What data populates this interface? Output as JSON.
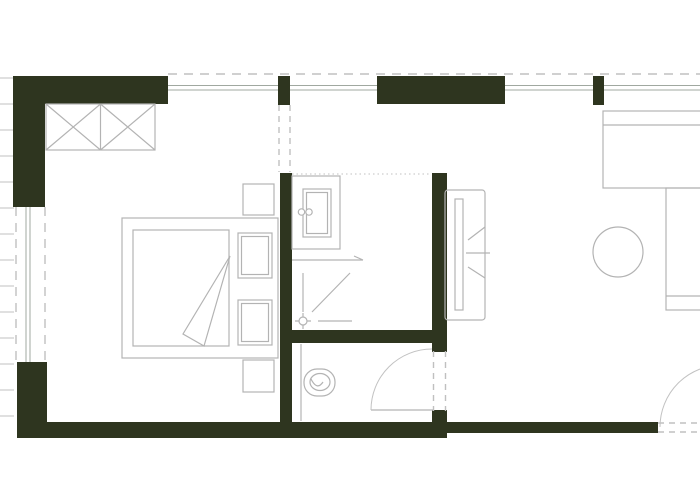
{
  "meta": {
    "type": "architectural-floor-plan",
    "description": "Small apartment plan: bedroom with wardrobe and double bed (left), bathroom with vanity and shower (center top), WC with toilet (center bottom), living area with TV unit, daybed, desk and round table (right). No text labels visible.",
    "canvas": {
      "width": 700,
      "height": 500
    },
    "background": "#ffffff"
  },
  "colors": {
    "wall": "#2e351f",
    "furniture_line": "#b3b3b3",
    "thin_line": "#c2c2c2",
    "window_line": "#a0a8a0",
    "dashed_line": "#c0c0c0"
  },
  "layers": [
    {
      "name": "exterior-hatching",
      "items": [
        {
          "name": "facade-hatch-marks",
          "kind": "path",
          "style": "thin",
          "d": "M0,78 H14 M0,104 H14 M0,130 H14 M0,156 H14 M0,182 H14 M0,208 H14 M0,234 H14 M0,260 H14 M0,286 H14 M0,312 H14 M0,338 H14 M0,364 H14 M0,390 H14 M0,416 H14"
        }
      ]
    },
    {
      "name": "walls",
      "items": [
        {
          "name": "wall-top-left",
          "kind": "rect",
          "style": "wall",
          "x": 13,
          "y": 76,
          "w": 155,
          "h": 28
        },
        {
          "name": "wall-left-upper",
          "kind": "rect",
          "style": "wall",
          "x": 13,
          "y": 76,
          "w": 32,
          "h": 131
        },
        {
          "name": "wall-left-lower",
          "kind": "rect",
          "style": "wall",
          "x": 17,
          "y": 362,
          "w": 30,
          "h": 76
        },
        {
          "name": "wall-bottom-left",
          "kind": "rect",
          "style": "wall",
          "x": 17,
          "y": 422,
          "w": 430,
          "h": 16
        },
        {
          "name": "wall-bottom-right",
          "kind": "rect",
          "style": "wall",
          "x": 447,
          "y": 422,
          "w": 211,
          "h": 11
        },
        {
          "name": "wall-bedroom-bathroom",
          "kind": "rect",
          "style": "wall",
          "x": 280,
          "y": 173,
          "w": 12,
          "h": 250
        },
        {
          "name": "wall-bathroom-right",
          "kind": "rect",
          "style": "wall",
          "x": 432,
          "y": 173,
          "w": 15,
          "h": 157
        },
        {
          "name": "wall-bathroom-wc-divider",
          "kind": "rect",
          "style": "wall",
          "x": 281,
          "y": 330,
          "w": 152,
          "h": 13
        },
        {
          "name": "wall-wc-right-upper-stub",
          "kind": "rect",
          "style": "wall",
          "x": 432,
          "y": 330,
          "w": 15,
          "h": 22
        },
        {
          "name": "wall-wc-right-lower-stub",
          "kind": "rect",
          "style": "wall",
          "x": 432,
          "y": 410,
          "w": 15,
          "h": 12
        },
        {
          "name": "wall-top-middle",
          "kind": "rect",
          "style": "wall",
          "x": 377,
          "y": 76,
          "w": 128,
          "h": 28
        },
        {
          "name": "pillar-top-left",
          "kind": "rect",
          "style": "wall",
          "x": 278,
          "y": 76,
          "w": 12,
          "h": 29
        },
        {
          "name": "pillar-top-right",
          "kind": "rect",
          "style": "wall",
          "x": 593,
          "y": 76,
          "w": 11,
          "h": 29
        }
      ]
    },
    {
      "name": "windows",
      "items": [
        {
          "name": "facade-dashed-line-top",
          "kind": "line",
          "style": "dashed",
          "x1": 168,
          "y1": 74,
          "x2": 700,
          "y2": 74
        },
        {
          "name": "window-top-1",
          "kind": "path",
          "style": "window",
          "d": "M168,85.5 H278 M168,90 H278"
        },
        {
          "name": "window-top-2",
          "kind": "path",
          "style": "window",
          "d": "M290,85.5 H377 M290,90 H377"
        },
        {
          "name": "window-top-3",
          "kind": "path",
          "style": "window",
          "d": "M505,85.5 H593 M505,90 H593"
        },
        {
          "name": "window-top-4",
          "kind": "path",
          "style": "window",
          "d": "M604,85.5 H700 M604,90 H700"
        },
        {
          "name": "window-left-glazing",
          "kind": "path",
          "style": "window",
          "d": "M26,207 V362 M30,207 V362"
        },
        {
          "name": "window-left-dashed-outer",
          "kind": "line",
          "style": "dashed",
          "x1": 16,
          "y1": 207,
          "x2": 16,
          "y2": 362
        },
        {
          "name": "window-left-dashed-inner",
          "kind": "line",
          "style": "dashed",
          "x1": 45,
          "y1": 207,
          "x2": 45,
          "y2": 362
        }
      ]
    },
    {
      "name": "passages-openings",
      "items": [
        {
          "name": "bathroom-passage-dashed-left",
          "kind": "line",
          "style": "dashed-small",
          "x1": 279,
          "y1": 105,
          "x2": 279,
          "y2": 172
        },
        {
          "name": "bathroom-passage-dashed-right",
          "kind": "line",
          "style": "dashed-small",
          "x1": 290,
          "y1": 105,
          "x2": 290,
          "y2": 172
        },
        {
          "name": "bathroom-top-dotted-boundary",
          "kind": "line",
          "style": "dotted",
          "x1": 292,
          "y1": 174,
          "x2": 431,
          "y2": 174
        },
        {
          "name": "wc-door-opening-dashed-a",
          "kind": "line",
          "style": "dashed-small",
          "x1": 433.5,
          "y1": 351,
          "x2": 433.5,
          "y2": 411
        },
        {
          "name": "wc-door-opening-dashed-b",
          "kind": "line",
          "style": "dashed-small",
          "x1": 445.5,
          "y1": 351,
          "x2": 445.5,
          "y2": 411
        },
        {
          "name": "entry-opening-dashed-a",
          "kind": "line",
          "style": "dashed-small",
          "x1": 658,
          "y1": 423,
          "x2": 700,
          "y2": 423
        },
        {
          "name": "entry-opening-dashed-b",
          "kind": "line",
          "style": "dashed-small",
          "x1": 658,
          "y1": 432,
          "x2": 700,
          "y2": 432
        }
      ]
    },
    {
      "name": "doors",
      "items": [
        {
          "name": "wc-door-leaf",
          "kind": "line",
          "style": "line",
          "x1": 371,
          "y1": 410,
          "x2": 433,
          "y2": 410
        },
        {
          "name": "wc-door-swing-arc",
          "kind": "path",
          "style": "thin",
          "d": "M371,410 A61,61 0 0 1 432,349"
        },
        {
          "name": "entry-door-swing-arc",
          "kind": "path",
          "style": "thin",
          "d": "M660,427 A62,62 0 0 1 722,365"
        }
      ]
    },
    {
      "name": "bedroom-furniture",
      "items": [
        {
          "name": "wardrobe-outline",
          "kind": "rect",
          "style": "line",
          "x": 46,
          "y": 104,
          "w": 109,
          "h": 46
        },
        {
          "name": "wardrobe-divider",
          "kind": "line",
          "style": "line",
          "x1": 100.5,
          "y1": 104,
          "x2": 100.5,
          "y2": 150
        },
        {
          "name": "wardrobe-cross-marks",
          "kind": "path",
          "style": "line",
          "d": "M46,104 L100.5,150 M46,150 L100.5,104 M100.5,104 L155,150 M100.5,150 L155,104"
        },
        {
          "name": "bed-frame",
          "kind": "rect",
          "style": "line",
          "x": 122,
          "y": 218,
          "w": 156,
          "h": 140
        },
        {
          "name": "bed-mattress",
          "kind": "rect",
          "style": "line",
          "x": 133,
          "y": 230,
          "w": 96,
          "h": 116
        },
        {
          "name": "bed-blanket-fold",
          "kind": "polygon",
          "style": "whitefill",
          "points": "230,256 183,334 204,346"
        },
        {
          "name": "bed-pillow-top-outer",
          "kind": "rect",
          "style": "whitefill",
          "x": 238,
          "y": 233,
          "w": 34,
          "h": 45
        },
        {
          "name": "bed-pillow-top-inner",
          "kind": "rect",
          "style": "line",
          "x": 241.5,
          "y": 236.5,
          "w": 27,
          "h": 38
        },
        {
          "name": "bed-pillow-bottom-outer",
          "kind": "rect",
          "style": "whitefill",
          "x": 238,
          "y": 300,
          "w": 34,
          "h": 45
        },
        {
          "name": "bed-pillow-bottom-inner",
          "kind": "rect",
          "style": "line",
          "x": 241.5,
          "y": 303.5,
          "w": 27,
          "h": 38
        },
        {
          "name": "nightstand-top",
          "kind": "rect",
          "style": "line",
          "x": 243,
          "y": 184,
          "w": 31,
          "h": 31
        },
        {
          "name": "nightstand-bottom",
          "kind": "rect",
          "style": "line",
          "x": 243,
          "y": 360,
          "w": 31,
          "h": 32
        }
      ]
    },
    {
      "name": "bathroom-fixtures",
      "items": [
        {
          "name": "vanity-counter",
          "kind": "rect",
          "style": "line",
          "x": 292,
          "y": 176,
          "w": 48,
          "h": 73
        },
        {
          "name": "sink-basin-outer",
          "kind": "rect",
          "style": "line",
          "x": 303,
          "y": 189,
          "w": 28,
          "h": 48
        },
        {
          "name": "sink-basin-inner",
          "kind": "rect",
          "style": "line",
          "x": 306.5,
          "y": 192.5,
          "w": 21,
          "h": 41
        },
        {
          "name": "faucet-handle-left",
          "kind": "circle",
          "style": "whitefill",
          "cx": 301.5,
          "cy": 212,
          "r": 3.2
        },
        {
          "name": "faucet-handle-right",
          "kind": "circle",
          "style": "whitefill",
          "cx": 309,
          "cy": 212,
          "r": 3.2
        },
        {
          "name": "shower-direction-arrow",
          "kind": "path",
          "style": "line",
          "d": "M292,260 H363 M354,256 L363,260"
        },
        {
          "name": "shower-corner-edge-vertical",
          "kind": "line",
          "style": "line",
          "x1": 303,
          "y1": 273,
          "x2": 303,
          "y2": 312
        },
        {
          "name": "shower-diagonal",
          "kind": "line",
          "style": "line",
          "x1": 350,
          "y1": 273,
          "x2": 312,
          "y2": 312
        },
        {
          "name": "shower-corner-edge-horizontal",
          "kind": "line",
          "style": "line",
          "x1": 318,
          "y1": 321,
          "x2": 352,
          "y2": 321
        },
        {
          "name": "shower-drain",
          "kind": "circle",
          "style": "whitefill",
          "cx": 303,
          "cy": 321,
          "r": 4
        },
        {
          "name": "shower-drain-ticks",
          "kind": "path",
          "style": "line",
          "d": "M303,313 V316.5 M303,325.5 V329 M295,321 H298.5 M307.5,321 H311"
        }
      ]
    },
    {
      "name": "wc-fixtures",
      "items": [
        {
          "name": "wc-wall-face-line",
          "kind": "line",
          "style": "line",
          "x1": 301,
          "y1": 344,
          "x2": 301,
          "y2": 421
        },
        {
          "name": "toilet-bowl-outer",
          "kind": "rect",
          "style": "whitefill",
          "x": 304,
          "y": 369,
          "w": 31,
          "h": 27,
          "rx": 13
        },
        {
          "name": "toilet-bowl-inner",
          "kind": "ellipse",
          "style": "line",
          "cx": 320,
          "cy": 382,
          "rx": 10,
          "ry": 8.5
        },
        {
          "name": "toilet-flush-detail",
          "kind": "path",
          "style": "line",
          "d": "M311,379 Q317,391 323,382"
        }
      ]
    },
    {
      "name": "living-room-furniture",
      "items": [
        {
          "name": "tv-unit-outline",
          "kind": "rect",
          "style": "line",
          "x": 445,
          "y": 190,
          "w": 40,
          "h": 130,
          "rx": 3
        },
        {
          "name": "tv-panel",
          "kind": "rect",
          "style": "line",
          "x": 455,
          "y": 199,
          "w": 8,
          "h": 111
        },
        {
          "name": "tv-bracket-marks",
          "kind": "path",
          "style": "line",
          "d": "M468,240 L485,227 M466,253 H490 M468,267 L485,278"
        },
        {
          "name": "daybed-outline",
          "kind": "rect",
          "style": "line",
          "x": 603,
          "y": 111,
          "w": 107,
          "h": 77
        },
        {
          "name": "daybed-backrest-line",
          "kind": "line",
          "style": "line",
          "x1": 603,
          "y1": 125,
          "x2": 710,
          "y2": 125
        },
        {
          "name": "side-desk-outline",
          "kind": "rect",
          "style": "line",
          "x": 666,
          "y": 188,
          "w": 46,
          "h": 122
        },
        {
          "name": "side-desk-shelf-line",
          "kind": "line",
          "style": "line",
          "x1": 666,
          "y1": 296,
          "x2": 712,
          "y2": 296
        },
        {
          "name": "round-table",
          "kind": "circle",
          "style": "line",
          "cx": 618,
          "cy": 252,
          "r": 25
        }
      ]
    }
  ]
}
